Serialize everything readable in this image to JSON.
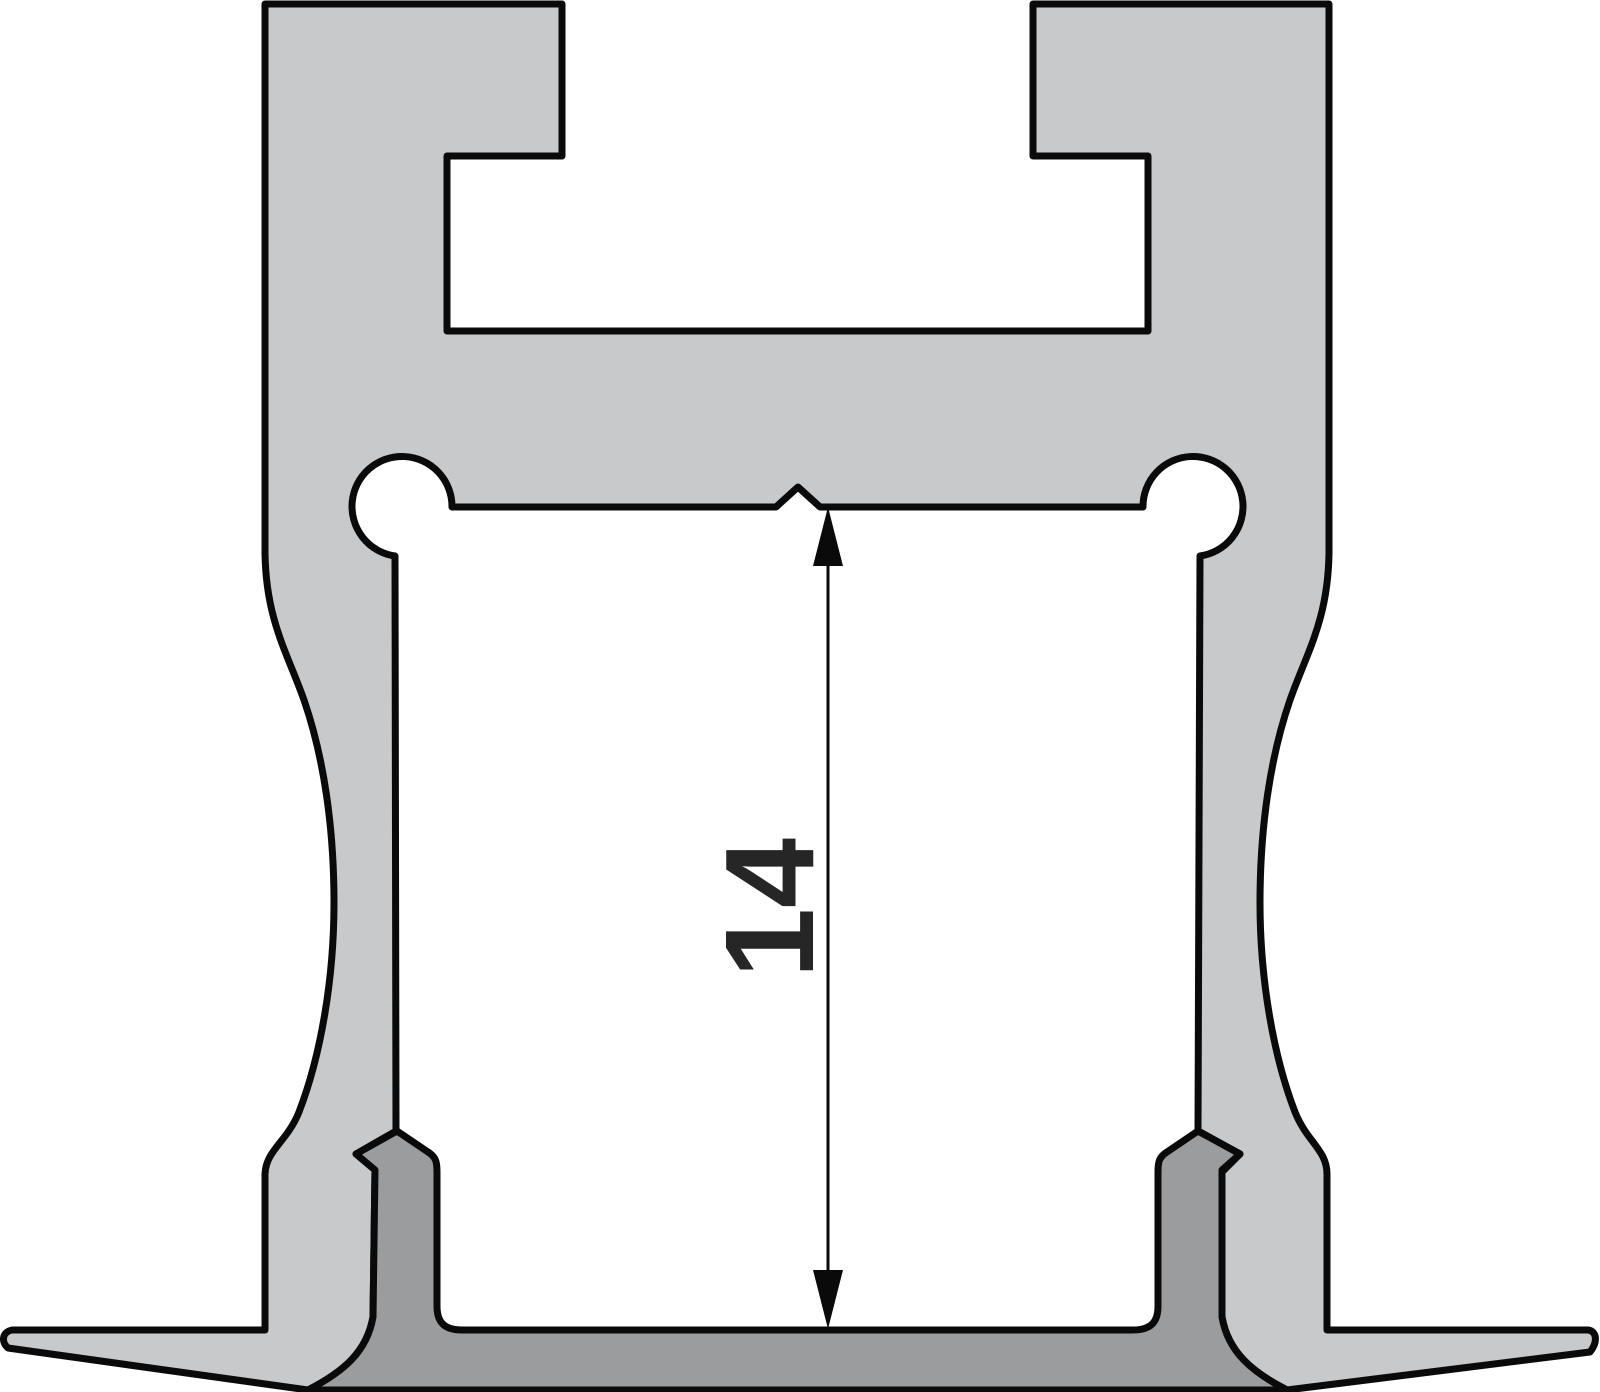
{
  "diagram": {
    "kind": "technical-cross-section",
    "subject": "recessed-aluminium-led-profile-with-cover",
    "dimension": {
      "value": "14",
      "orientation": "vertical",
      "measures": "inner height between cavity ceiling and cover plate"
    },
    "colors": {
      "profile_fill": "#c8c9cb",
      "cover_fill": "#9b9c9e",
      "outline": "#0a0a0a",
      "label": "#262626",
      "background": "#ffffff"
    }
  }
}
